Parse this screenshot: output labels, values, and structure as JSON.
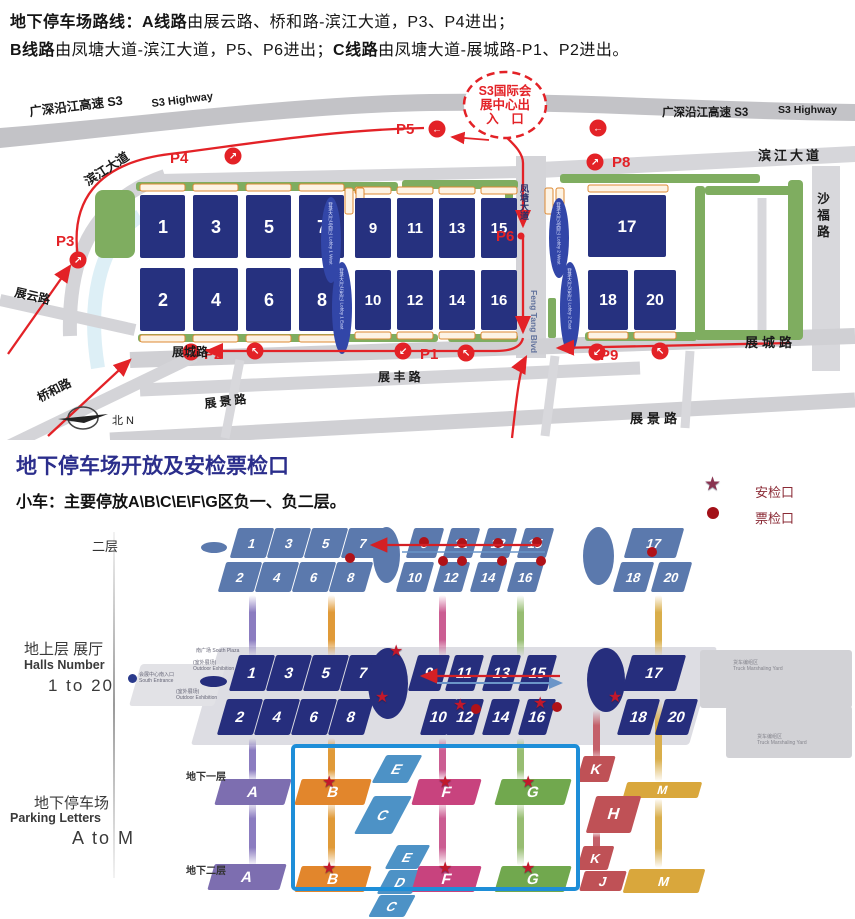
{
  "icons": {
    "star": "★",
    "dot": "●",
    "arrow_ne": "↗",
    "arrow_left": "←",
    "arrow_sw": "↙",
    "arrow_nw": "↖"
  },
  "colors": {
    "route_red": "#e32227",
    "hall_navy": "#26317f",
    "hall_steel": "#5b79ad",
    "highlight_blue": "#1e8ed8",
    "title_blue": "#2b2e8c",
    "legend_maroon": "#8a2a35"
  },
  "header": {
    "intro": "地下停车场路线：",
    "route_a": "A线路",
    "route_a_rest": "由展云路、桥和路-滨江大道，P3、P4进出；",
    "route_b": "B线路",
    "route_b_rest": "由凤塘大道-滨江大道，P5、P6进出；",
    "route_c": "C线路",
    "route_c_rest": "由凤塘大道-展城路-P1、P2进出。"
  },
  "map": {
    "s3_cn": "广深沿江高速 S3",
    "s3_en": "S3 Highway",
    "binjiang": "滨江大道",
    "shafu": "沙福路",
    "zhanyun": "展云路",
    "qiaohe": "桥和路",
    "zhanjing": "展景路",
    "zhancheng": "展城路",
    "zhanfeng": "展 丰 路",
    "fengtang": "凤塘大道",
    "fengtang_en": "Feng Tang Blvd",
    "compass": "北 N",
    "exit_line1": "S3国际会",
    "exit_line2": "展中心出",
    "exit_line3": "入　口",
    "p1": "P1",
    "p2": "P2",
    "p3": "P3",
    "p4": "P4",
    "p5": "P5",
    "p6": "P6",
    "p8": "P8",
    "p9": "P9",
    "lobby1w": "登录大厅1(西厅) Lobby 1 West",
    "lobby1e": "登录大厅1(东厅) Lobby 1 East",
    "lobby2w": "登录大厅2(西厅) Lobby 2 West",
    "lobby2e": "登录大厅2(东厅) Lobby 2 East"
  },
  "halls": {
    "top": [
      "1",
      "3",
      "5",
      "7",
      "9",
      "11",
      "13",
      "15",
      "17"
    ],
    "bottom": [
      "2",
      "4",
      "6",
      "8",
      "10",
      "12",
      "14",
      "16",
      "18",
      "20"
    ]
  },
  "section2": {
    "title": "地下停车场开放及安检票检口",
    "car_label": "小车：",
    "car_text": "主要停放A\\B\\C\\E\\F\\G区负一、负二层。",
    "legend_security": "安检口",
    "legend_ticket": "票检口"
  },
  "levels": {
    "floor2_label": "二层",
    "ground_cn": "地上层 展厅",
    "ground_en": "Halls Number",
    "ground_range": "1 to 20",
    "park_cn": "地下停车场",
    "park_en": "Parking Letters",
    "park_range": "A to M",
    "b1_label": "地下一层",
    "b2_label": "地下二层",
    "south_plaza_cn": "南广场",
    "south_plaza_en": "South Plaza",
    "outdoor_cn": "(室外展场)",
    "outdoor_en": "Outdoor Exhibition",
    "entrance_cn": "会展中心南入口",
    "entrance_en": "South Entrance",
    "truck_cn": "货车编组区",
    "truck_en": "Truck Marshaling Yard",
    "b1": {
      "A": "A",
      "B": "B",
      "C": "C",
      "E": "E",
      "F": "F",
      "G": "G",
      "K": "K",
      "H": "H",
      "M": "M"
    },
    "b2": {
      "A": "A",
      "B": "B",
      "C": "C",
      "D": "D",
      "E": "E",
      "F": "F",
      "G": "G",
      "K": "K",
      "J": "J",
      "M": "M"
    }
  }
}
